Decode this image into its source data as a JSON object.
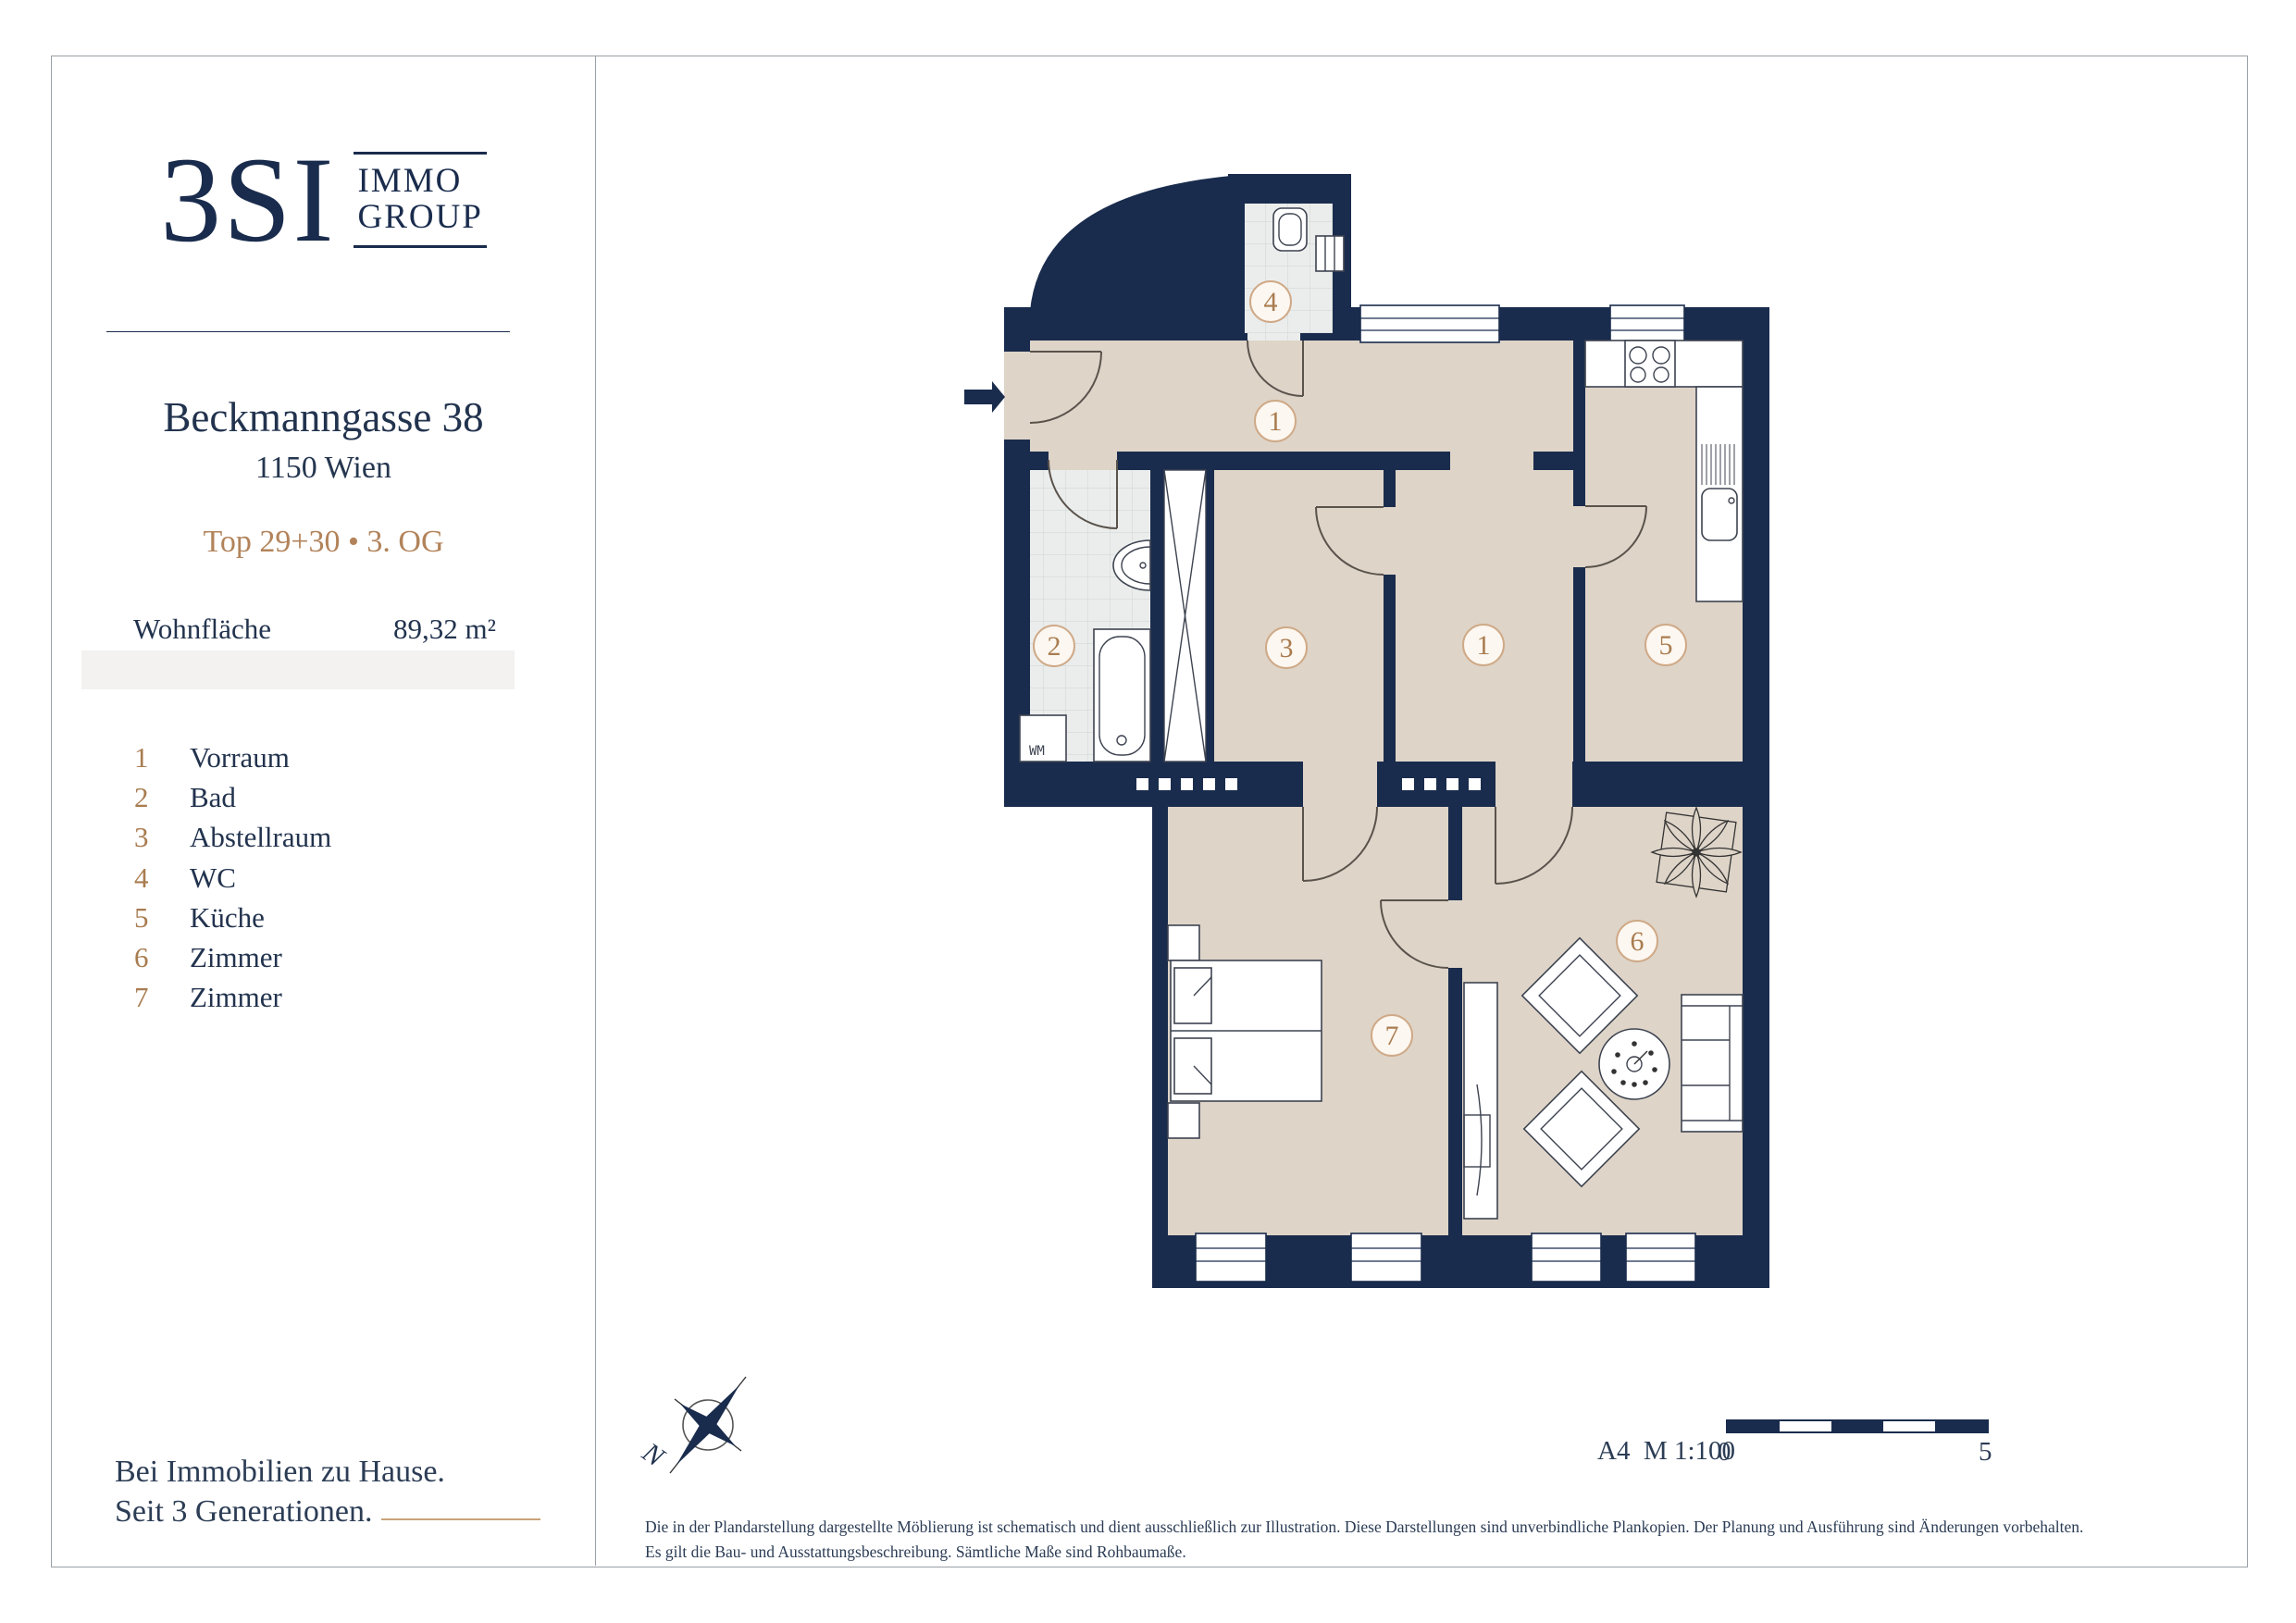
{
  "brand": {
    "logo": "3SI",
    "immo": "IMMO",
    "group": "GROUP"
  },
  "sidebar": {
    "address": "Beckmanngasse 38",
    "city": "1150 Wien",
    "unit_line": "Top 29+30 • 3. OG",
    "area_label": "Wohnfläche",
    "area_value": "89,32 m²",
    "tagline_line1": "Bei Immobilien zu Hause.",
    "tagline_line2": "Seit 3 Generationen."
  },
  "legend": {
    "items": [
      {
        "num": "1",
        "label": "Vorraum"
      },
      {
        "num": "2",
        "label": "Bad"
      },
      {
        "num": "3",
        "label": "Abstellraum"
      },
      {
        "num": "4",
        "label": "WC"
      },
      {
        "num": "5",
        "label": "Küche"
      },
      {
        "num": "6",
        "label": "Zimmer"
      },
      {
        "num": "7",
        "label": "Zimmer"
      }
    ]
  },
  "plan": {
    "wm_label": "WM",
    "compass_north": "N"
  },
  "footer": {
    "sheet_scale": "A4  M 1:100",
    "scalebar_start": "0",
    "scalebar_end": "5",
    "disclaimer": "Die in der Plandarstellung dargestellte Möblierung ist schematisch und dient ausschließlich zur Illustration. Diese Darstellungen sind unverbindliche Plankopien. Der Planung und Ausführung sind Änderungen vorbehalten. Es gilt die Bau- und Ausstattungsbeschreibung. Sämtliche Maße sind Rohbaumaße."
  },
  "colors": {
    "navy": "#1a2c4d",
    "accent": "#b2835a",
    "accent2": "#a97c50",
    "floor": "#ded4c8",
    "tile": "#ebedec",
    "circle_stroke": "#cfa987",
    "tan_line": "#c9a37a"
  }
}
